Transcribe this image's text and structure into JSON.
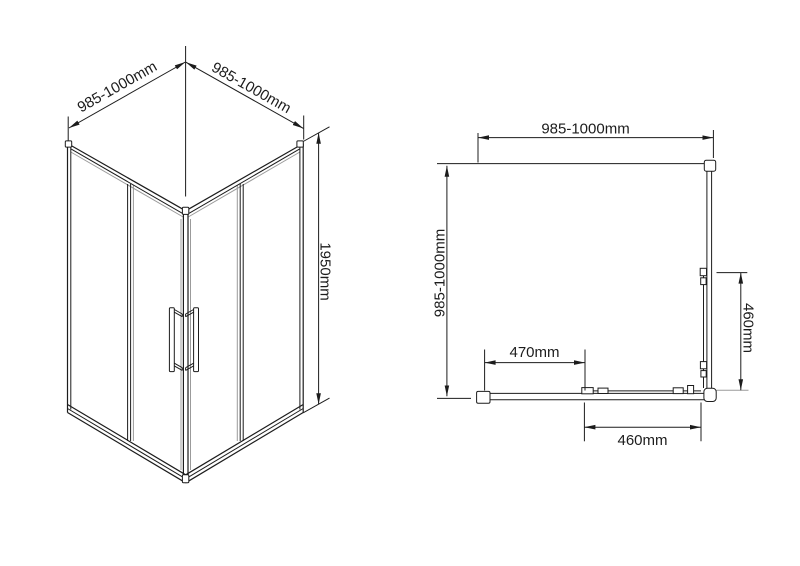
{
  "drawing": {
    "type": "shower-enclosure-technical-drawing",
    "isometric_view": {
      "dim_left": "985-1000mm",
      "dim_right": "985-1000mm",
      "dim_height": "1950mm"
    },
    "plan_view": {
      "dim_top": "985-1000mm",
      "dim_side": "985-1000mm",
      "dim_opening": "470mm",
      "dim_door_bottom": "460mm",
      "dim_door_right": "460mm"
    }
  },
  "colors": {
    "line": "#1c1c1c",
    "glass_gray": "#9b9b9b",
    "background": "#ffffff"
  }
}
